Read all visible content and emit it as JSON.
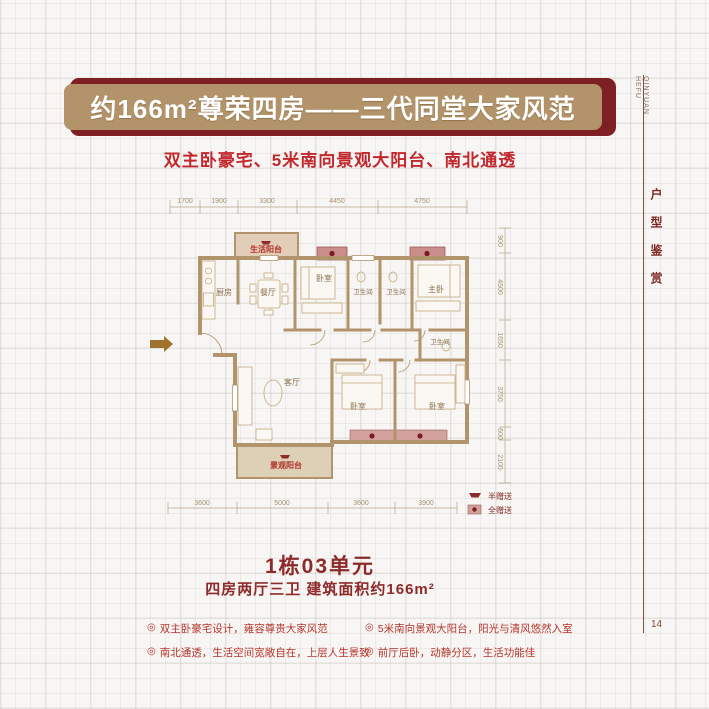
{
  "banner": {
    "title": "约166m²尊荣四房——三代同堂大家风范",
    "back_color": "#7e2023",
    "front_color": "#b3946a",
    "text_color": "#ffffff"
  },
  "subtitle": {
    "text": "双主卧豪宅、5米南向景观大阳台、南北通透",
    "color": "#c2272d"
  },
  "floorplan": {
    "dims_top": [
      "1700",
      "1900",
      "3300",
      "4450",
      "4750"
    ],
    "dims_bottom": [
      "3600",
      "5000",
      "3600",
      "3900"
    ],
    "dims_right": [
      "900",
      "4500",
      "1650",
      "3750",
      "600",
      "2100"
    ],
    "rooms": {
      "life_balcony": "生活阳台",
      "kitchen": "厨房",
      "dining": "餐厅",
      "bedroom_top": "卧室",
      "bath1": "卫生间",
      "bath2": "卫生间",
      "master": "主卧",
      "bath3": "卫生间",
      "living": "客厅",
      "bedroom_left": "卧室",
      "bedroom_right": "卧室",
      "view_balcony": "景观阳台"
    },
    "legend": {
      "half": "半赠送",
      "full": "全赠送"
    },
    "colors": {
      "wall": "#b1946c",
      "gift_full": "#c98e8b",
      "gift_strip": "#d3a19e",
      "marker": "#7a1b1e",
      "balcony_fill": "#e2cdb8",
      "view_balcony_fill": "#ddd0b6"
    }
  },
  "unit": {
    "title": "1栋03单元",
    "spec": "四房两厅三卫 建筑面积约166m²"
  },
  "features": [
    "双主卧豪宅设计，雍容尊贵大家风范",
    "南北通透，生活空间宽敞自在，上层人生景致",
    "5米南向景观大阳台，阳光与清风悠然入室",
    "前厅后卧，动静分区，生活功能佳"
  ],
  "feature_bullet": "◎",
  "sidebar": {
    "brand_line1": "QINYUAN",
    "brand_line2": "HEFU",
    "section_title": "户型鉴赏",
    "page_number": "14"
  }
}
